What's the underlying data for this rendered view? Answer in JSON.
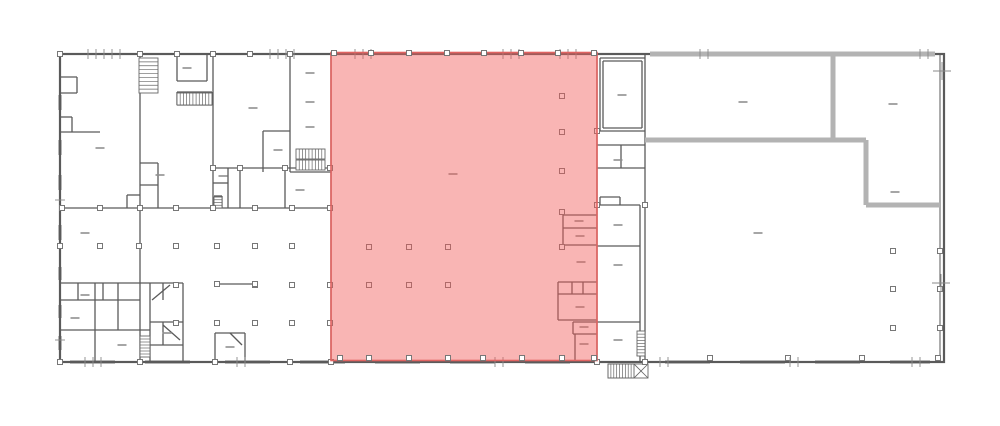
{
  "plan": {
    "canvas": {
      "width": 1000,
      "height": 426
    },
    "colors": {
      "background": "#ffffff",
      "wall": "#5a5a5a",
      "wall_thick": "#b3b3b3",
      "window": "#a9a9a9",
      "column_stroke": "#777777",
      "column_fill": "#ffffff",
      "dash": "#8f8f8f",
      "tick": "#8a8a8a",
      "stair": "#666666",
      "highlight_fill": "#f15b58",
      "highlight_opacity": 0.45,
      "highlight_stroke": "#e06361"
    },
    "outer": [
      60,
      54,
      884,
      308
    ],
    "inner_right_wall": [
      940,
      54,
      940,
      362
    ],
    "highlight": {
      "x": 331,
      "y": 52.5,
      "width": 266,
      "height": 308
    },
    "thick_walls": [
      [
        650,
        54,
        935,
        54
      ],
      [
        833,
        56,
        833,
        140
      ],
      [
        645,
        140,
        866,
        140
      ],
      [
        866,
        140,
        866,
        205
      ],
      [
        866,
        205,
        940,
        205
      ]
    ],
    "walls": [
      [
        140,
        54,
        140,
        362
      ],
      [
        213,
        54,
        213,
        210
      ],
      [
        290,
        54,
        290,
        172
      ],
      [
        60,
        132,
        100,
        132
      ],
      [
        60,
        208,
        331,
        208
      ],
      [
        213,
        168,
        331,
        168
      ],
      [
        290,
        172,
        331,
        172
      ],
      [
        177,
        55,
        177,
        81
      ],
      [
        177,
        81,
        207,
        81
      ],
      [
        207,
        55,
        207,
        81
      ],
      [
        177,
        92,
        212,
        92
      ],
      [
        177,
        105,
        212,
        105
      ],
      [
        177,
        92,
        177,
        105
      ],
      [
        212,
        92,
        212,
        105
      ],
      [
        60,
        77,
        77,
        77
      ],
      [
        77,
        77,
        77,
        93
      ],
      [
        60,
        93,
        77,
        93
      ],
      [
        60,
        117,
        72,
        117
      ],
      [
        72,
        117,
        72,
        132
      ],
      [
        140,
        163,
        158,
        163
      ],
      [
        158,
        163,
        158,
        208
      ],
      [
        140,
        185,
        158,
        185
      ],
      [
        127,
        195,
        140,
        195
      ],
      [
        127,
        195,
        127,
        208
      ],
      [
        263,
        131,
        290,
        131
      ],
      [
        263,
        131,
        263,
        172
      ],
      [
        240,
        168,
        240,
        208
      ],
      [
        228,
        168,
        228,
        208
      ],
      [
        285,
        168,
        285,
        208
      ],
      [
        213,
        183,
        228,
        183
      ],
      [
        214,
        196,
        222,
        196
      ],
      [
        222,
        196,
        222,
        208
      ],
      [
        60,
        283,
        183,
        283
      ],
      [
        183,
        283,
        183,
        362
      ],
      [
        60,
        300,
        140,
        300
      ],
      [
        60,
        330,
        150,
        330
      ],
      [
        95,
        283,
        95,
        362
      ],
      [
        118,
        283,
        118,
        330
      ],
      [
        78,
        283,
        78,
        300
      ],
      [
        103,
        283,
        103,
        300
      ],
      [
        150,
        283,
        150,
        362
      ],
      [
        163,
        283,
        163,
        300
      ],
      [
        150,
        322,
        183,
        322
      ],
      [
        163,
        322,
        163,
        345
      ],
      [
        150,
        345,
        183,
        345
      ],
      [
        215,
        333,
        215,
        362
      ],
      [
        215,
        333,
        245,
        333
      ],
      [
        245,
        333,
        245,
        362
      ],
      [
        331,
        54,
        331,
        362
      ],
      [
        597,
        54,
        597,
        362
      ],
      [
        563,
        215,
        597,
        215
      ],
      [
        563,
        215,
        563,
        245
      ],
      [
        563,
        228,
        597,
        228
      ],
      [
        563,
        245,
        597,
        245
      ],
      [
        558,
        282,
        597,
        282
      ],
      [
        558,
        282,
        558,
        320
      ],
      [
        558,
        320,
        597,
        320
      ],
      [
        558,
        294,
        597,
        294
      ],
      [
        572,
        282,
        572,
        294
      ],
      [
        583,
        282,
        583,
        294
      ],
      [
        573,
        322,
        597,
        322
      ],
      [
        573,
        322,
        573,
        334
      ],
      [
        573,
        334,
        597,
        334
      ],
      [
        575,
        334,
        575,
        362
      ],
      [
        645,
        54,
        645,
        362
      ],
      [
        600,
        58,
        645,
        58
      ],
      [
        600,
        58,
        600,
        131
      ],
      [
        603,
        61,
        642,
        61
      ],
      [
        603,
        61,
        603,
        128
      ],
      [
        603,
        128,
        642,
        128
      ],
      [
        642,
        61,
        642,
        128
      ],
      [
        597,
        131,
        645,
        131
      ],
      [
        597,
        145,
        645,
        145
      ],
      [
        621,
        145,
        621,
        168
      ],
      [
        597,
        168,
        645,
        168
      ],
      [
        600,
        197,
        620,
        197
      ],
      [
        620,
        197,
        620,
        205
      ],
      [
        600,
        197,
        600,
        205
      ],
      [
        597,
        205,
        640,
        205
      ],
      [
        640,
        205,
        640,
        362
      ],
      [
        597,
        246,
        640,
        246
      ],
      [
        597,
        322,
        640,
        322
      ],
      [
        637,
        356,
        645,
        331
      ],
      [
        217,
        284,
        255,
        284
      ],
      [
        152,
        300,
        170,
        285
      ],
      [
        163,
        325,
        180,
        340
      ],
      [
        230,
        333,
        242,
        345
      ]
    ],
    "windows": [
      [
        60,
        95,
        60,
        110
      ],
      [
        60,
        140,
        60,
        155
      ],
      [
        60,
        175,
        60,
        190
      ],
      [
        60,
        225,
        60,
        240
      ],
      [
        60,
        267,
        60,
        280
      ],
      [
        60,
        305,
        60,
        318
      ],
      [
        60,
        336,
        60,
        350
      ],
      [
        70,
        362,
        115,
        362
      ],
      [
        145,
        362,
        190,
        362
      ],
      [
        225,
        362,
        270,
        362
      ],
      [
        300,
        362,
        345,
        362
      ],
      [
        375,
        362,
        420,
        362
      ],
      [
        450,
        362,
        495,
        362
      ],
      [
        525,
        362,
        570,
        362
      ],
      [
        665,
        362,
        710,
        362
      ],
      [
        740,
        362,
        785,
        362
      ],
      [
        815,
        362,
        860,
        362
      ],
      [
        890,
        362,
        930,
        362
      ]
    ],
    "stairs": [
      {
        "x": 139,
        "y": 58,
        "w": 19,
        "h": 35,
        "dir": "v",
        "n": 9
      },
      {
        "x": 177,
        "y": 93,
        "w": 35,
        "h": 12,
        "dir": "h",
        "n": 11
      },
      {
        "x": 296,
        "y": 149,
        "w": 29,
        "h": 10,
        "dir": "h",
        "n": 9
      },
      {
        "x": 296,
        "y": 160,
        "w": 29,
        "h": 10,
        "dir": "h",
        "n": 9
      },
      {
        "x": 140,
        "y": 336,
        "w": 10,
        "h": 21,
        "dir": "v",
        "n": 7
      },
      {
        "x": 214,
        "y": 197,
        "w": 8,
        "h": 11,
        "dir": "v",
        "n": 4
      },
      {
        "x": 637,
        "y": 331,
        "w": 8,
        "h": 25,
        "dir": "v",
        "n": 8
      },
      {
        "x": 608,
        "y": 364,
        "w": 26,
        "h": 14,
        "dir": "h",
        "n": 9
      }
    ],
    "exterior_stair_outline": [
      608,
      364,
      40,
      14
    ],
    "exterior_stair_diagonals": [
      [
        634,
        378,
        648,
        364
      ],
      [
        634,
        364,
        648,
        378
      ]
    ],
    "columns_main": [
      [
        60,
        54
      ],
      [
        140,
        54
      ],
      [
        177,
        54
      ],
      [
        213,
        54
      ],
      [
        250,
        54
      ],
      [
        290,
        54
      ],
      [
        60,
        246
      ],
      [
        100,
        246
      ],
      [
        139,
        246
      ],
      [
        176,
        246
      ],
      [
        217,
        246
      ],
      [
        255,
        246
      ],
      [
        292,
        246
      ],
      [
        176,
        285
      ],
      [
        255,
        285
      ],
      [
        292,
        285
      ],
      [
        330,
        285
      ],
      [
        176,
        323
      ],
      [
        217,
        323
      ],
      [
        255,
        323
      ],
      [
        292,
        323
      ],
      [
        330,
        323
      ],
      [
        62,
        208
      ],
      [
        100,
        208
      ],
      [
        140,
        208
      ],
      [
        176,
        208
      ],
      [
        213,
        208
      ],
      [
        255,
        208
      ],
      [
        292,
        208
      ],
      [
        330,
        208
      ],
      [
        213,
        168
      ],
      [
        240,
        168
      ],
      [
        285,
        168
      ],
      [
        330,
        168
      ],
      [
        217,
        284
      ],
      [
        255,
        284
      ],
      [
        60,
        362
      ],
      [
        140,
        362
      ],
      [
        215,
        362
      ],
      [
        290,
        362
      ],
      [
        331,
        362
      ],
      [
        597,
        362
      ],
      [
        645,
        362
      ],
      [
        710,
        358
      ],
      [
        788,
        358
      ],
      [
        862,
        358
      ],
      [
        938,
        358
      ],
      [
        893,
        251
      ],
      [
        893,
        289
      ],
      [
        893,
        328
      ],
      [
        940,
        251
      ],
      [
        940,
        289
      ],
      [
        940,
        328
      ],
      [
        597,
        131
      ],
      [
        597,
        205
      ],
      [
        645,
        205
      ]
    ],
    "columns_red_inner": [
      [
        369,
        247
      ],
      [
        409,
        247
      ],
      [
        448,
        247
      ],
      [
        369,
        285
      ],
      [
        409,
        285
      ],
      [
        448,
        285
      ],
      [
        562,
        96
      ],
      [
        562,
        132
      ],
      [
        562,
        171
      ],
      [
        562,
        212
      ],
      [
        562,
        247
      ]
    ],
    "columns_red_edge": [
      [
        334,
        53
      ],
      [
        371,
        53
      ],
      [
        409,
        53
      ],
      [
        447,
        53
      ],
      [
        484,
        53
      ],
      [
        521,
        53
      ],
      [
        558,
        53
      ],
      [
        594,
        53
      ],
      [
        340,
        358
      ],
      [
        369,
        358
      ],
      [
        409,
        358
      ],
      [
        448,
        358
      ],
      [
        483,
        358
      ],
      [
        522,
        358
      ],
      [
        562,
        358
      ],
      [
        594,
        358
      ]
    ],
    "dashes": [
      [
        85,
        233
      ],
      [
        100,
        148
      ],
      [
        187,
        68
      ],
      [
        253,
        108
      ],
      [
        278,
        150
      ],
      [
        300,
        190
      ],
      [
        160,
        175
      ],
      [
        223,
        176
      ],
      [
        310,
        73
      ],
      [
        310,
        102
      ],
      [
        310,
        127
      ],
      [
        85,
        295
      ],
      [
        75,
        318
      ],
      [
        122,
        345
      ],
      [
        230,
        347
      ],
      [
        167,
        333
      ],
      [
        453,
        174
      ],
      [
        579,
        221
      ],
      [
        580,
        236
      ],
      [
        581,
        262
      ],
      [
        580,
        307
      ],
      [
        584,
        327
      ],
      [
        584,
        344
      ],
      [
        622,
        95
      ],
      [
        618,
        160
      ],
      [
        618,
        225
      ],
      [
        618,
        265
      ],
      [
        618,
        340
      ],
      [
        743,
        102
      ],
      [
        893,
        104
      ],
      [
        758,
        233
      ],
      [
        895,
        192
      ]
    ],
    "ticks_top": [
      88,
      96,
      104,
      112,
      120,
      270,
      278,
      286,
      294,
      355,
      363,
      371,
      503,
      511,
      519,
      560,
      568,
      576,
      700,
      708,
      920,
      928
    ],
    "ticks_bottom": [
      85,
      93,
      101,
      237,
      245,
      495,
      503,
      660,
      668,
      790,
      798,
      912,
      920
    ],
    "ticks_left": [
      200,
      340
    ],
    "crosses": [
      [
        942,
        71
      ],
      [
        941,
        283
      ]
    ]
  }
}
